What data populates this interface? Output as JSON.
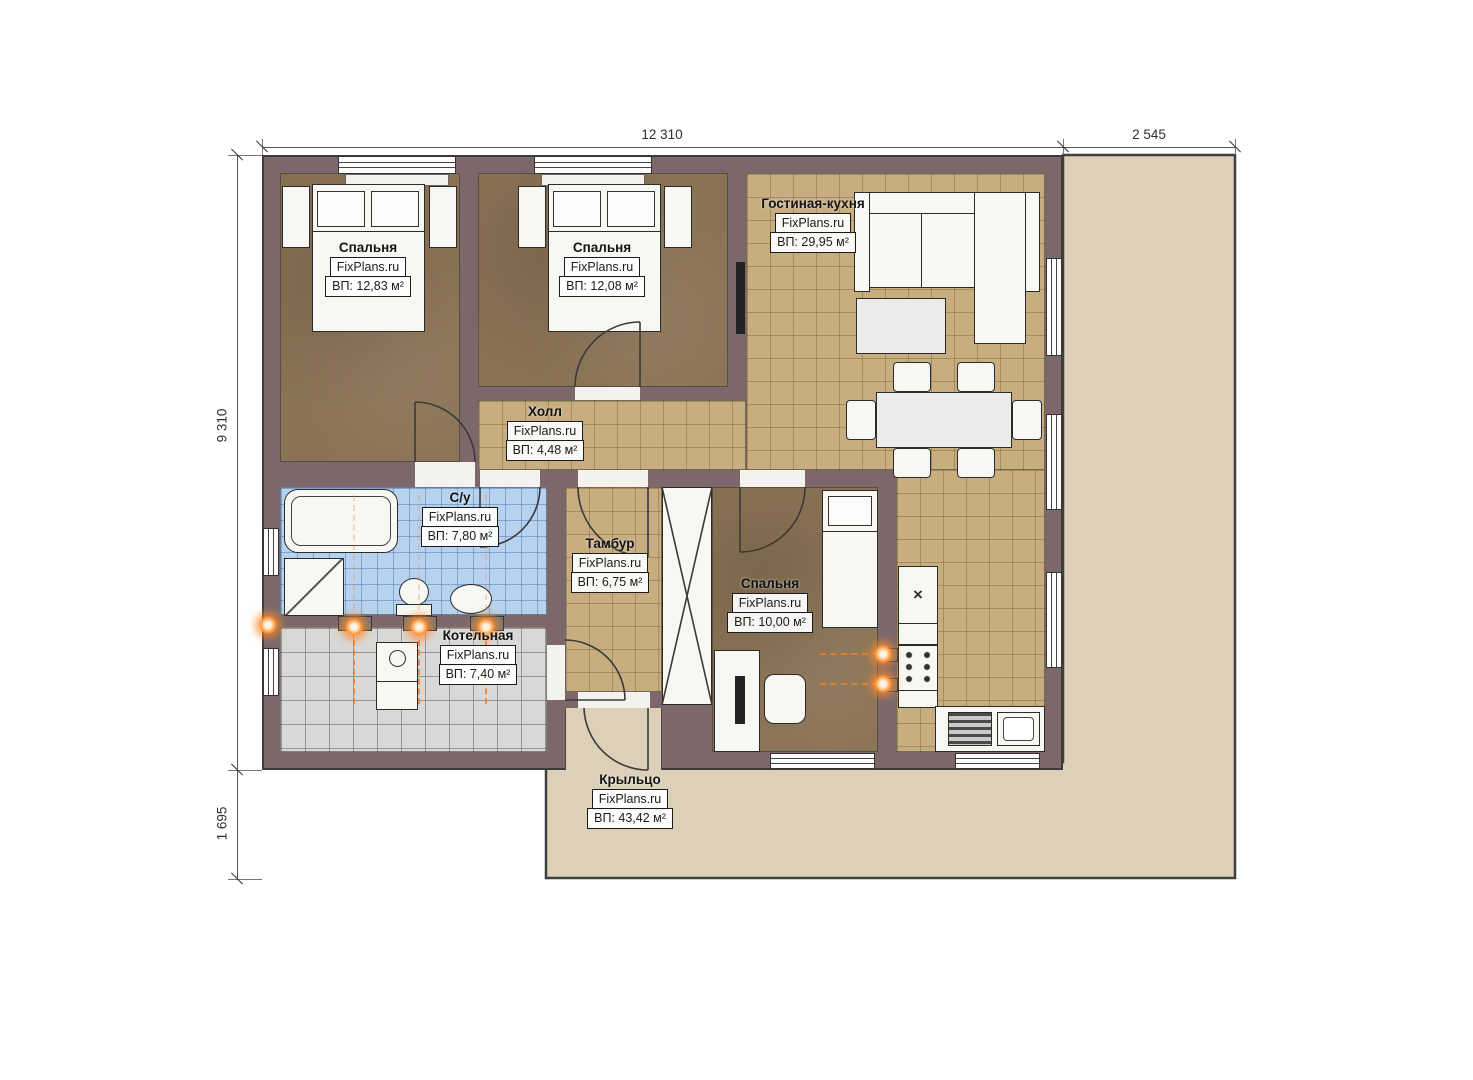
{
  "dimensions": {
    "top": "12 310",
    "top_right": "2 545",
    "left": "9 310",
    "bottom_left": "1 695"
  },
  "rooms": {
    "bedroom1": {
      "name": "Спальня",
      "brand": "FixPlans.ru",
      "area": "ВП: 12,83 м²"
    },
    "bedroom2": {
      "name": "Спальня",
      "brand": "FixPlans.ru",
      "area": "ВП: 12,08 м²"
    },
    "living_kitchen": {
      "name": "Гостиная-кухня",
      "brand": "FixPlans.ru",
      "area": "ВП: 29,95 м²"
    },
    "hall": {
      "name": "Холл",
      "brand": "FixPlans.ru",
      "area": "ВП: 4,48 м²"
    },
    "bathroom": {
      "name": "С/у",
      "brand": "FixPlans.ru",
      "area": "ВП: 7,80 м²"
    },
    "vestibule": {
      "name": "Тамбур",
      "brand": "FixPlans.ru",
      "area": "ВП: 6,75 м²"
    },
    "bedroom3": {
      "name": "Спальня",
      "brand": "FixPlans.ru",
      "area": "ВП: 10,00 м²"
    },
    "boiler_room": {
      "name": "Котельная",
      "brand": "FixPlans.ru",
      "area": "ВП: 7,40 м²"
    },
    "porch": {
      "name": "Крыльцо",
      "brand": "FixPlans.ru",
      "area": "ВП: 43,42 м²"
    }
  },
  "icons": {
    "fridge_mark": "×"
  },
  "colors": {
    "wall": "#7c686b",
    "floor_wood": "#8a7254",
    "floor_tile_tan": "#c7ad80",
    "floor_tile_blue": "#b7d2ee",
    "floor_tile_grey": "#d8d8d6",
    "porch": "#dcd0b8",
    "radiator": "#ff9538"
  }
}
